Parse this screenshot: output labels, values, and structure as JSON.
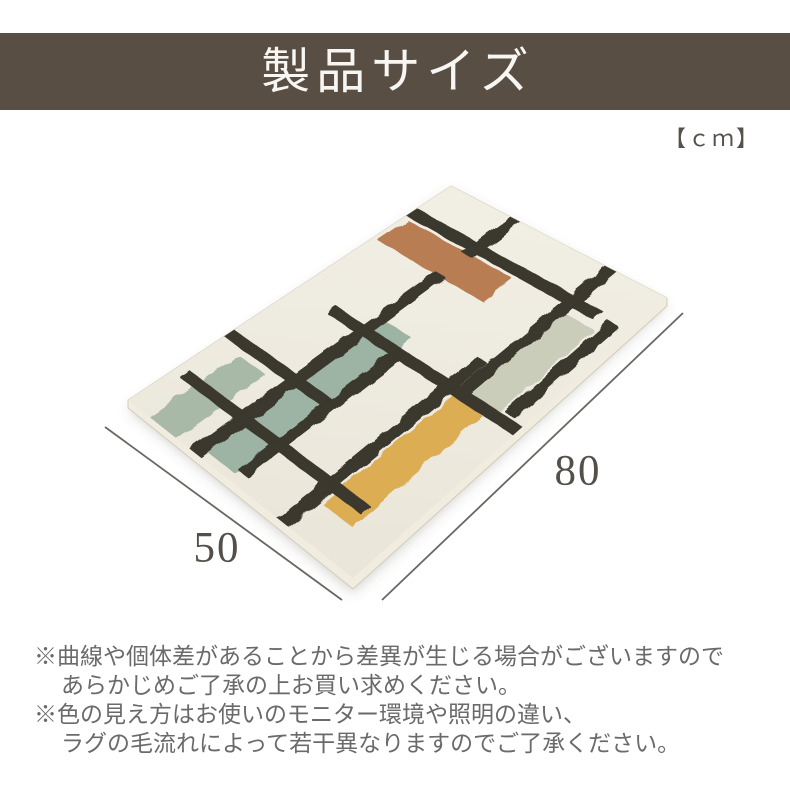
{
  "header": {
    "title": "製品サイズ",
    "bg_color": "#594e44",
    "text_color": "#f8f6f3"
  },
  "unit_label": "【ｃｍ】",
  "unit_label_color": "#57514b",
  "diagram": {
    "width_label": "80",
    "depth_label": "50",
    "label_color": "#544f48",
    "line_color": "#6b6661",
    "dimension_lines": {
      "width": {
        "x1": 683,
        "y1": 313,
        "x2": 382,
        "y2": 600
      },
      "depth": {
        "x1": 105,
        "y1": 427,
        "x2": 342,
        "y2": 600
      }
    }
  },
  "rug": {
    "corners": {
      "t": [
        451,
        186
      ],
      "r": [
        667,
        298
      ],
      "l": [
        128,
        400
      ],
      "b": [
        353,
        578
      ]
    },
    "local_size": [
      50,
      80
    ],
    "base_color": "#e9e5d8",
    "base_color_light": "#f1eee4",
    "side_color": "#f0ece0",
    "side_edge_color": "#d2ccbc",
    "shadow_color": "rgba(90,82,70,0.25)",
    "pattern_colors": {
      "charcoal": "#3b372e",
      "terracotta": "#b97d53",
      "sage": "#9db3a3",
      "pale_sage": "#c9cdb9",
      "small_sage": "#a9b9a8",
      "mustard": "#dcad52"
    },
    "stripes": [
      {
        "x": [
          1,
          25
        ],
        "y": [
          12,
          19
        ],
        "color": "#b97d53"
      },
      {
        "x": [
          38.5,
          44.5
        ],
        "y": [
          13,
          37
        ],
        "color": "#c9cdb9"
      },
      {
        "x": [
          15.5,
          22
        ],
        "y": [
          34,
          78
        ],
        "color": "#9db3a3"
      },
      {
        "x": [
          5,
          10.5
        ],
        "y": [
          58,
          80
        ],
        "color": "#a9b9a8"
      },
      {
        "x": [
          36.5,
          43
        ],
        "y": [
          38,
          72
        ],
        "color": "#dcad52"
      },
      {
        "x": [
          0,
          43
        ],
        "y": [
          8.8,
          10.8
        ],
        "color": "#3b372e"
      },
      {
        "x": [
          8,
          50
        ],
        "y": [
          37,
          39
        ],
        "color": "#3b372e"
      },
      {
        "x": [
          0,
          23
        ],
        "y": [
          54,
          56
        ],
        "color": "#3b372e"
      },
      {
        "x": [
          2,
          42
        ],
        "y": [
          67,
          69
        ],
        "color": "#3b372e"
      },
      {
        "x": [
          14,
          16
        ],
        "y": [
          0,
          12
        ],
        "color": "#3b372e"
      },
      {
        "x": [
          14,
          16
        ],
        "y": [
          19,
          80
        ],
        "color": "#3b372e"
      },
      {
        "x": [
          22,
          24
        ],
        "y": [
          38,
          77
        ],
        "color": "#3b372e"
      },
      {
        "x": [
          36,
          38
        ],
        "y": [
          0,
          38
        ],
        "color": "#3b372e"
      },
      {
        "x": [
          45.5,
          47.5
        ],
        "y": [
          10,
          36
        ],
        "color": "#3b372e"
      },
      {
        "x": [
          33.5,
          35.5
        ],
        "y": [
          30,
          80
        ],
        "color": "#3b372e"
      }
    ]
  },
  "notes": [
    "※曲線や個体差があることから差異が生じる場合がございますので",
    "あらかじめご了承の上お買い求めください。",
    "※色の見え方はお使いのモニター環境や照明の違い、",
    "ラグの毛流れによって若干異なりますのでご了承ください。"
  ],
  "notes_color": "#6a6a6a"
}
